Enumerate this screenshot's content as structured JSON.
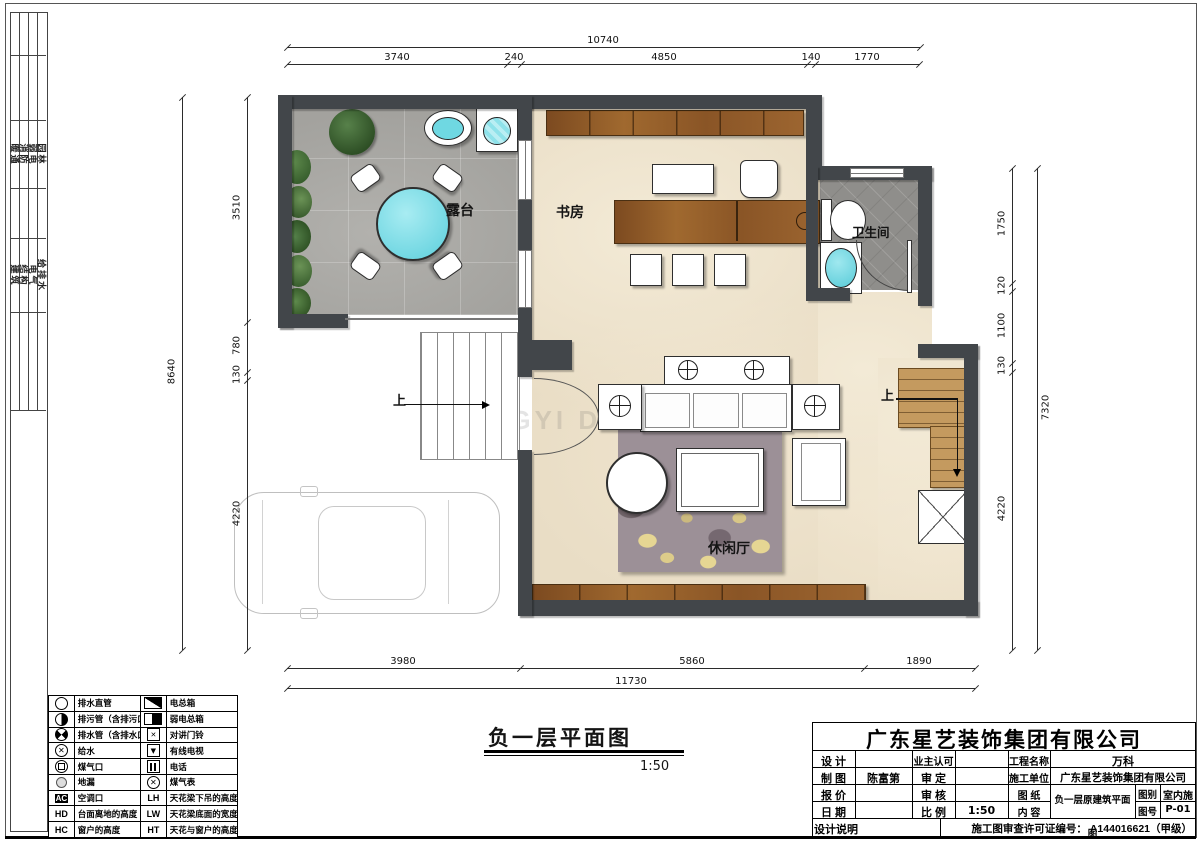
{
  "plan": {
    "rooms": {
      "terrace": "露台",
      "study": "书房",
      "bathroom": "卫生间",
      "lounge": "休闲厅"
    },
    "stair_up_left": "上",
    "stair_up_right": "上",
    "watermark": "XINGYI DECORATION"
  },
  "dims": {
    "top_total": "10740",
    "top": [
      "3740",
      "240",
      "4850",
      "140",
      "1770"
    ],
    "bottom": [
      "3980",
      "5860",
      "1890"
    ],
    "bottom_total": "11730",
    "left_total": "8640",
    "left": [
      "3510",
      "780",
      "130",
      "4220"
    ],
    "right": [
      "1750",
      "120",
      "1100",
      "130",
      "4220"
    ],
    "right_total": "7320"
  },
  "margin": {
    "a": [
      "暖通",
      "消防",
      "弱电",
      "园林"
    ],
    "b": [
      "建筑",
      "结构",
      "电气",
      "给排水"
    ]
  },
  "figure": {
    "title": "负一层平面图",
    "scale": "1:50"
  },
  "legend": {
    "left": [
      {
        "label": "排水直管"
      },
      {
        "label": "排污管（含排污口）"
      },
      {
        "label": "排水管（含排水口）"
      },
      {
        "label": "给水"
      },
      {
        "label": "煤气口"
      },
      {
        "label": "地漏"
      },
      {
        "code": "AC",
        "label": "空调口"
      },
      {
        "code": "HD",
        "label": "台面离地的高度"
      },
      {
        "code": "HC",
        "label": "窗户的高度"
      }
    ],
    "right": [
      {
        "label": "电总箱"
      },
      {
        "label": "弱电总箱"
      },
      {
        "label": "对讲门铃"
      },
      {
        "label": "有线电视"
      },
      {
        "label": "电话"
      },
      {
        "label": "煤气表"
      },
      {
        "code": "LH",
        "label": "天花梁下吊的高度"
      },
      {
        "code": "LW",
        "label": "天花梁底面的宽度"
      },
      {
        "code": "HT",
        "label": "天花与窗户的高度"
      }
    ]
  },
  "title_block": {
    "company": "广东星艺装饰集团有限公司",
    "design_label": "设  计",
    "owner_label": "业主认可",
    "project_label": "工程名称",
    "project_value": "万科",
    "draft_label": "制  图",
    "draft_value": "陈富第",
    "approve_label": "审  定",
    "contractor_label": "施工单位",
    "contractor_value": "广东星艺装饰集团有限公司",
    "quote_label": "报  价",
    "review_label": "审  核",
    "sheet_label": "图  纸",
    "content_value": "负一层原建筑平面图",
    "type_label": "图别",
    "type_value": "室内施",
    "date_label": "日  期",
    "scale_label": "比  例",
    "scale_value": "1:50",
    "content_label": "内  容",
    "no_label": "图号",
    "no_value": "P-01",
    "notes_label": "设计说明",
    "permit": "施工图审查许可证编号：  A144016621（甲级）"
  }
}
